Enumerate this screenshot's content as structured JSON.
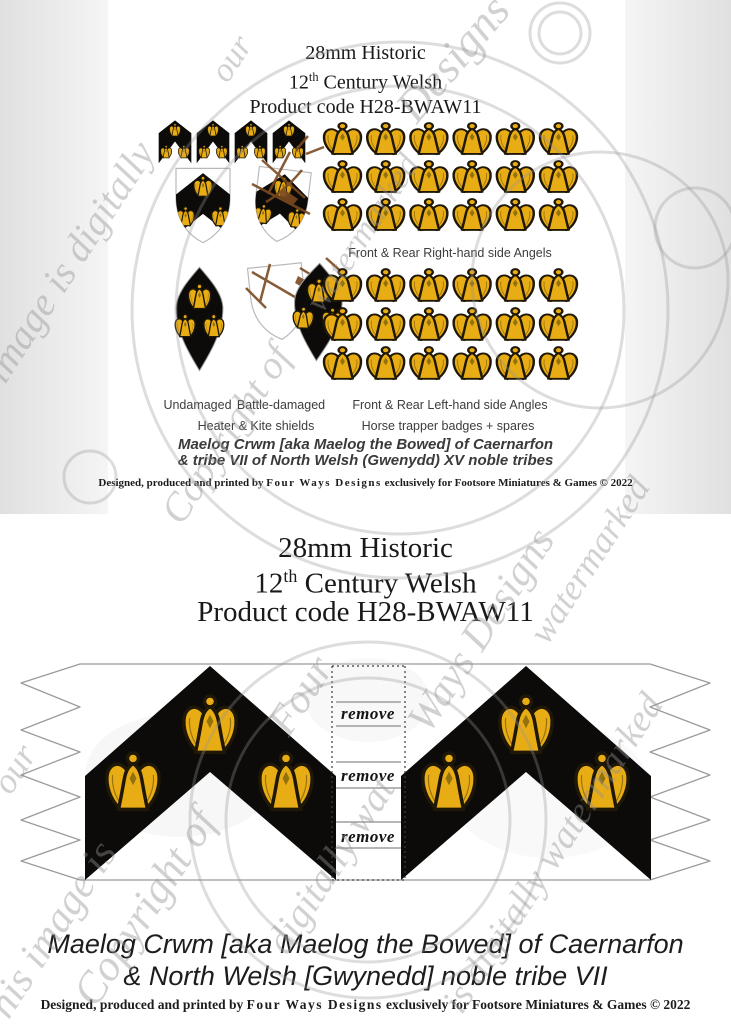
{
  "colors": {
    "gold": "#E8AC15",
    "outline": "#201806",
    "black": "#0C0B09",
    "damage_brown": "#7B4A20",
    "watermark_gray": "#919191",
    "background_band": "#E0E0E0"
  },
  "top_sheet": {
    "title": {
      "line1": "28mm Historic",
      "line2_num": "12",
      "line2_sup": "th",
      "line2_rest": " Century Welsh",
      "line3": "Product code H28-BWAW11"
    },
    "labels": {
      "right_angels": "Front & Rear Right-hand side Angels",
      "undamaged": "Undamaged",
      "battle_damaged": "Battle-damaged",
      "left_angels": "Front & Rear Left-hand side Angles",
      "shields": "Heater & Kite shields",
      "badges": "Horse trapper badges + spares"
    },
    "caption": {
      "line1": "Maelog Crwm [aka Maelog the Bowed] of Caernarfon",
      "line2": "& tribe VII of North Welsh (Gwenydd) XV noble tribes"
    },
    "copyright": {
      "pre": "Designed, produced and printed by ",
      "brand": "Four Ways Designs",
      "post": " exclusively for Footsore Miniatures & Games © 2022"
    },
    "grid": {
      "cols": 6,
      "rows": 3
    },
    "badge_count": 4
  },
  "banner_sheet": {
    "title": {
      "line1": "28mm Historic",
      "line2_num": "12",
      "line2_sup": "th",
      "line2_rest": " Century Welsh",
      "line3": "Product code H28-BWAW11"
    },
    "remove_label": "remove",
    "remove_count": 3,
    "caption": {
      "line1": "Maelog Crwm [aka Maelog the Bowed] of Caernarfon",
      "line2": "& North Welsh [Gwynedd] noble tribe VII"
    },
    "copyright": {
      "pre": "Designed, produced and printed by ",
      "brand": "Four Ways Designs",
      "post": " exclusively for Footsore Miniatures & Games © 2022"
    }
  },
  "watermark": {
    "texts": [
      {
        "text": "This image is digitally",
        "x": -30,
        "y": 450,
        "size": 40,
        "rot": -57
      },
      {
        "text": "Copyright of",
        "x": 190,
        "y": 525,
        "size": 40,
        "rot": -57
      },
      {
        "text": "Designs",
        "x": 425,
        "y": 125,
        "size": 46,
        "rot": -50
      },
      {
        "text": "our",
        "x": 235,
        "y": 85,
        "size": 34,
        "rot": -57
      },
      {
        "text": "watermarked",
        "x": 330,
        "y": 315,
        "size": 34,
        "rot": -57
      },
      {
        "text": "Copyright of",
        "x": 105,
        "y": 1008,
        "size": 44,
        "rot": -57
      },
      {
        "text": "This image is",
        "x": 5,
        "y": 1040,
        "size": 42,
        "rot": -57
      },
      {
        "text": "our",
        "x": 18,
        "y": 795,
        "size": 36,
        "rot": -57
      },
      {
        "text": "Four",
        "x": 298,
        "y": 738,
        "size": 42,
        "rot": -57
      },
      {
        "text": "Ways Designs",
        "x": 438,
        "y": 735,
        "size": 42,
        "rot": -57
      },
      {
        "text": "digitally wat",
        "x": 295,
        "y": 955,
        "size": 40,
        "rot": -57
      },
      {
        "text": "is digitally watermarked",
        "x": 470,
        "y": 1015,
        "size": 38,
        "rot": -57
      },
      {
        "text": "watermarked",
        "x": 555,
        "y": 645,
        "size": 36,
        "rot": -57
      }
    ]
  }
}
